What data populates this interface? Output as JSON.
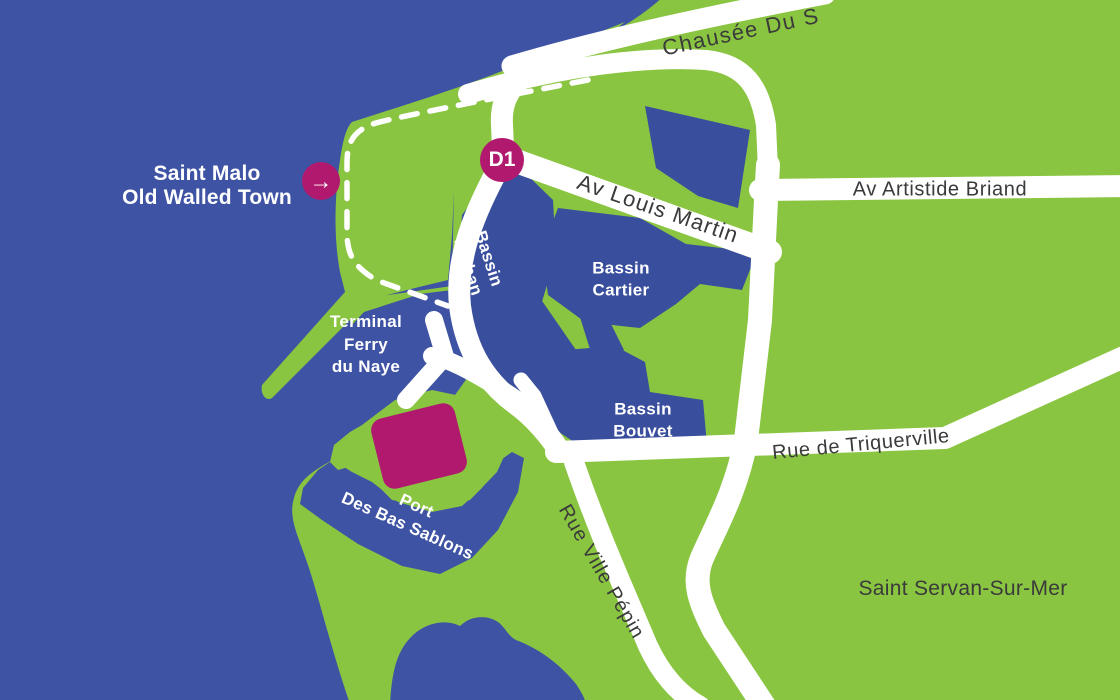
{
  "colors": {
    "sea": "#3E53A4",
    "basin": "#394E9D",
    "land": "#8AC541",
    "road": "#FFFFFF",
    "highlight": "#B0196E",
    "label_dark": "#3A3A3A",
    "label_light": "#FFFFFF"
  },
  "places": {
    "old_town": {
      "line1": "Saint Malo",
      "line2": "Old Walled Town"
    },
    "district": "Saint Servan-Sur-Mer",
    "terminal": {
      "line1": "Terminal",
      "line2": "Ferry",
      "line3": "du Naye"
    }
  },
  "marker": {
    "d1": "D1",
    "arrow_icon": "→"
  },
  "roads": {
    "chaussee": "Chausée Du S",
    "louis_martin": "Av Louis Martin",
    "artistide_briand": "Av Artistide Briand",
    "triquerville": "Rue de Triquerville",
    "ville_pepin": "Rue Ville Pépin"
  },
  "basins": {
    "vauban": {
      "line1": "Bassin",
      "line2": "Vauban"
    },
    "cartier": {
      "line1": "Bassin",
      "line2": "Cartier"
    },
    "bouvet": {
      "line1": "Bassin",
      "line2": "Bouvet"
    },
    "port": {
      "line1": "Port",
      "line2": "Des Bas Sablons"
    }
  }
}
